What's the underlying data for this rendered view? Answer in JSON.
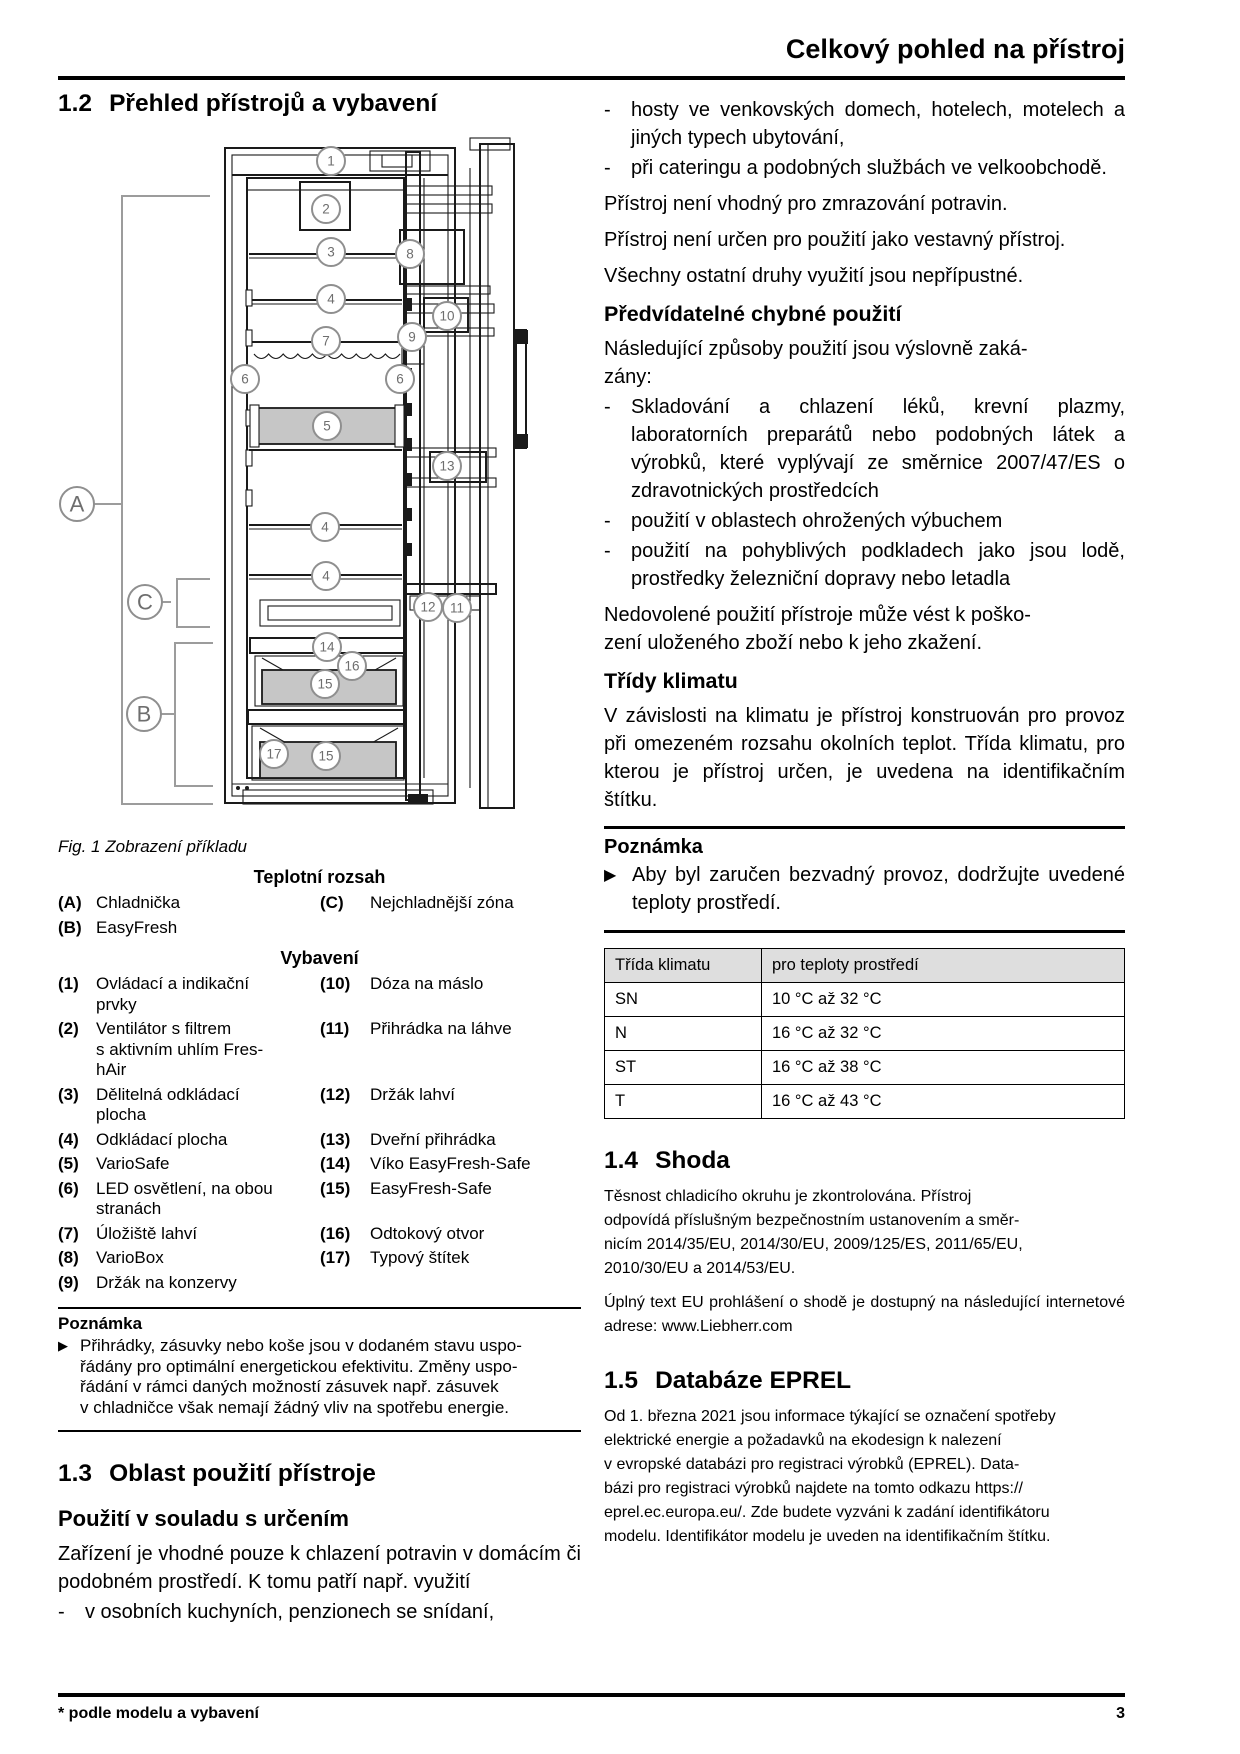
{
  "header": {
    "title": "Celkový pohled na přístroj"
  },
  "footer": {
    "note": "* podle modelu a vybavení",
    "page_number": "3"
  },
  "left": {
    "s12": {
      "num": "1.2",
      "title": "Přehled přístrojů a vybavení"
    },
    "figure": {
      "caption": "Fig. 1 Zobrazení příkladu",
      "callouts": [
        "1",
        "2",
        "3",
        "8",
        "4",
        "10",
        "9",
        "7",
        "6",
        "6",
        "5",
        "13",
        "4",
        "4",
        "12",
        "11",
        "14",
        "16",
        "15",
        "17",
        "15"
      ],
      "zones": [
        "A",
        "C",
        "B"
      ]
    },
    "temperature_legend": {
      "title": "Teplotní rozsah",
      "rows": [
        {
          "l_key": "(A)",
          "l_label": "Chladnička",
          "r_key": "(C)",
          "r_label": "Nejchladnější zóna"
        },
        {
          "l_key": "(B)",
          "l_label": "EasyFresh",
          "r_key": "",
          "r_label": ""
        }
      ]
    },
    "equipment_legend": {
      "title": "Vybavení",
      "rows": [
        {
          "l_key": "(1)",
          "l_label": [
            "Ovládací a indikační",
            "prvky"
          ],
          "r_key": "(10)",
          "r_label": "Dóza na máslo"
        },
        {
          "l_key": "(2)",
          "l_label": [
            "Ventilátor s filtrem",
            "s aktivním uhlím Fres-",
            "hAir"
          ],
          "r_key": "(11)",
          "r_label": "Přihrádka na láhve"
        },
        {
          "l_key": "(3)",
          "l_label": [
            "Dělitelná odkládací",
            "plocha"
          ],
          "r_key": "(12)",
          "r_label": "Držák lahví"
        },
        {
          "l_key": "(4)",
          "l_label": "Odkládací plocha",
          "r_key": "(13)",
          "r_label": "Dveřní přihrádka"
        },
        {
          "l_key": "(5)",
          "l_label": "VarioSafe",
          "r_key": "(14)",
          "r_label": "Víko EasyFresh-Safe"
        },
        {
          "l_key": "(6)",
          "l_label": [
            "LED osvětlení, na obou",
            "stranách"
          ],
          "r_key": "(15)",
          "r_label": "EasyFresh-Safe"
        },
        {
          "l_key": "(7)",
          "l_label": "Úložiště lahví",
          "r_key": "(16)",
          "r_label": "Odtokový otvor"
        },
        {
          "l_key": "(8)",
          "l_label": "VarioBox",
          "r_key": "(17)",
          "r_label": "Typový štítek"
        },
        {
          "l_key": "(9)",
          "l_label": "Držák na konzervy",
          "r_key": "",
          "r_label": ""
        }
      ]
    },
    "note": {
      "title": "Poznámka",
      "text": [
        "Přihrádky, zásuvky nebo koše jsou v dodaném stavu uspo-",
        "řádány pro optimální energetickou efektivitu. Změny uspo-",
        "řádání v rámci daných možností zásuvek např. zásuvek",
        "v chladničce však nemají žádný vliv na spotřebu energie."
      ]
    },
    "s13": {
      "num": "1.3",
      "title": "Oblast použití přístroje",
      "subheading": "Použití v souladu s určením",
      "p1": "Zařízení je vhodné pouze k chlazení potravin v domácím či podobném prostředí. K tomu patří např. využití",
      "bullet": "v osobních kuchyních, penzionech se snídaní,"
    }
  },
  "right": {
    "intro_bullets": [
      "hosty ve venkovských domech, hotelech, motelech a jiných typech ubytování,",
      "při cateringu a podobných službách ve velkoobchodě."
    ],
    "p_freeze": "Přístroj není vhodný pro zmrazování potravin.",
    "p_builtin": "Přístroj není určen pro použití jako vestavný přístroj.",
    "p_other": "Všechny ostatní druhy využití jsou nepřípustné.",
    "h_misuse": "Předvídatelné chybné použití",
    "p_misuse_intro": [
      "Následující způsoby použití jsou výslovně zaká-",
      "zány:"
    ],
    "misuse_bullets": [
      "Skladování a chlazení léků, krevní plazmy, laboratorních preparátů nebo podobných látek a výrobků, které vyplývají ze směrnice 2007/47/ES o zdravotnických prostředcích",
      "použití v oblastech ohrožených výbuchem",
      "použití na pohyblivých podkladech jako jsou lodě, prostředky železniční dopravy nebo letadla"
    ],
    "p_damage": [
      "Nedovolené použití přístroje může vést k poško-",
      "zení uloženého zboží nebo k jeho zkažení."
    ],
    "h_climate": "Třídy klimatu",
    "p_climate": "V závislosti na klimatu je přístroj konstruován pro provoz při omezeném rozsahu okolních teplot. Třída klimatu, pro kterou je přístroj určen, je uvedena na identifikačním štítku.",
    "note": {
      "title": "Poznámka",
      "text": "Aby byl zaručen bezvadný provoz, dodržujte uvedené teploty prostředí."
    },
    "climate_table": {
      "headers": [
        "Třída klimatu",
        "pro teploty prostředí"
      ],
      "rows": [
        [
          "SN",
          "10 °C až 32 °C"
        ],
        [
          "N",
          "16 °C až 32 °C"
        ],
        [
          "ST",
          "16 °C až 38 °C"
        ],
        [
          "T",
          "16 °C až 43 °C"
        ]
      ]
    },
    "s14": {
      "num": "1.4",
      "title": "Shoda",
      "p1": [
        "Těsnost chladicího okruhu je zkontrolována. Přístroj",
        "odpovídá příslušným bezpečnostním ustanovením a směr-",
        "nicím 2014/35/EU, 2014/30/EU, 2009/125/ES, 2011/65/EU,",
        "2010/30/EU a 2014/53/EU."
      ],
      "p2": "Úplný text EU prohlášení o shodě je dostupný na následující internetové adrese: www.Liebherr.com"
    },
    "s15": {
      "num": "1.5",
      "title": "Databáze EPREL",
      "p1": [
        "Od 1. března 2021 jsou informace týkající se označení spotřeby",
        "elektrické energie a požadavků na ekodesign k nalezení",
        "v evropské databázi pro registraci výrobků (EPREL). Data-",
        "bázi pro registraci výrobků najdete na tomto odkazu https://",
        "eprel.ec.europa.eu/. Zde budete vyzváni k zadání identifikátoru",
        "modelu. Identifikátor modelu je uveden na identifikačním štítku."
      ]
    }
  }
}
